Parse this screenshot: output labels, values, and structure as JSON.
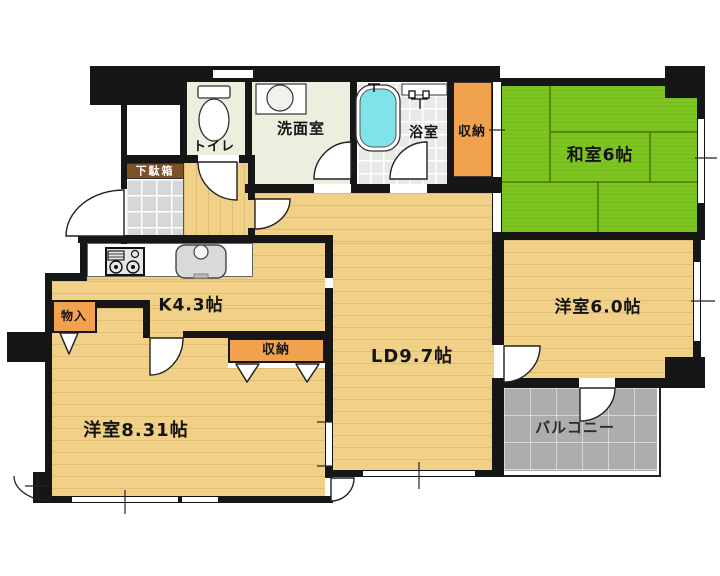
{
  "floorplan": {
    "rooms": [
      {
        "id": "toilet",
        "label": "トイレ"
      },
      {
        "id": "washroom",
        "label": "洗面室"
      },
      {
        "id": "bathroom",
        "label": "浴室"
      },
      {
        "id": "storage-upper",
        "label": "収納"
      },
      {
        "id": "japanese-room",
        "label": "和室6帖"
      },
      {
        "id": "shoe-cabinet",
        "label": "下駄箱"
      },
      {
        "id": "closet",
        "label": "物入"
      },
      {
        "id": "kitchen",
        "label": "K4.3帖"
      },
      {
        "id": "storage-lower",
        "label": "収納"
      },
      {
        "id": "western-room-large",
        "label": "洋室8.31帖"
      },
      {
        "id": "living-dining",
        "label": "LD9.7帖"
      },
      {
        "id": "western-room-small",
        "label": "洋室6.0帖"
      },
      {
        "id": "balcony",
        "label": "バルコニー"
      }
    ],
    "fixtures": [
      "toilet-bowl",
      "washbasin",
      "bathtub",
      "shower-head",
      "gas-stove",
      "kitchen-sink",
      "door-swing-arc",
      "closet-door-triangle",
      "window"
    ],
    "colors": {
      "wall": "#161616",
      "wood_floor": "#f0d187",
      "tatami": "#7fc520",
      "service_floor": "#edeedd",
      "storage": "#f0a24f",
      "balcony": "#adadad",
      "bathtub": "#7ee4ea",
      "shoe_cabinet": "#7c5126",
      "entrance_tile": "#d7d7d7"
    }
  }
}
